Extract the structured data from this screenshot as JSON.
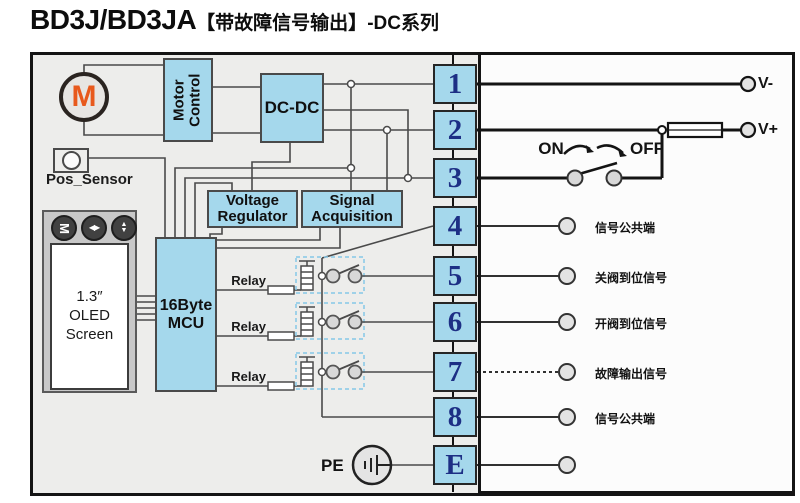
{
  "title": {
    "model": "BD3J/BD3JA",
    "tag": "【带故障信号输出】",
    "series": "-DC系列"
  },
  "motor": {
    "label": "M"
  },
  "blocks": {
    "motor_control": {
      "line1": "Motor",
      "line2": "Control"
    },
    "dcdc": {
      "label": "DC-DC"
    },
    "voltage_regulator": {
      "line1": "Voltage",
      "line2": "Regulator"
    },
    "signal_acquisition": {
      "line1": "Signal",
      "line2": "Acquisition"
    },
    "mcu": {
      "line1": "16Byte",
      "line2": "MCU"
    },
    "pos_sensor": {
      "label": "Pos_Sensor"
    },
    "oled": {
      "line1": "1.3″",
      "line2": "OLED",
      "line3": "Screen"
    }
  },
  "oled_buttons": {
    "menu": "M",
    "leftright": "◀▶",
    "up": "▲",
    "down": "▼"
  },
  "relays": {
    "r1": "Relay",
    "r2": "Relay",
    "r3": "Relay"
  },
  "switch": {
    "on": "ON",
    "off": "OFF"
  },
  "power": {
    "vminus": "V-",
    "vplus": "V+"
  },
  "ground": {
    "label": "PE"
  },
  "terminals": {
    "t1": "1",
    "t2": "2",
    "t3": "3",
    "t4": "4",
    "t5": "5",
    "t6": "6",
    "t7": "7",
    "t8": "8",
    "te": "E"
  },
  "signals": {
    "s4": "信号公共端",
    "s5": "关阀到位信号",
    "s6": "开阀到位信号",
    "s7": "故障输出信号",
    "s8": "信号公共端"
  },
  "colors": {
    "box_blue": "#a5d8ec",
    "panel_gray": "#ededeb",
    "navy": "#1d2f85",
    "orange": "#e8591c",
    "wire": "#4a4a4a",
    "dashed_blue": "#85c8e8"
  }
}
